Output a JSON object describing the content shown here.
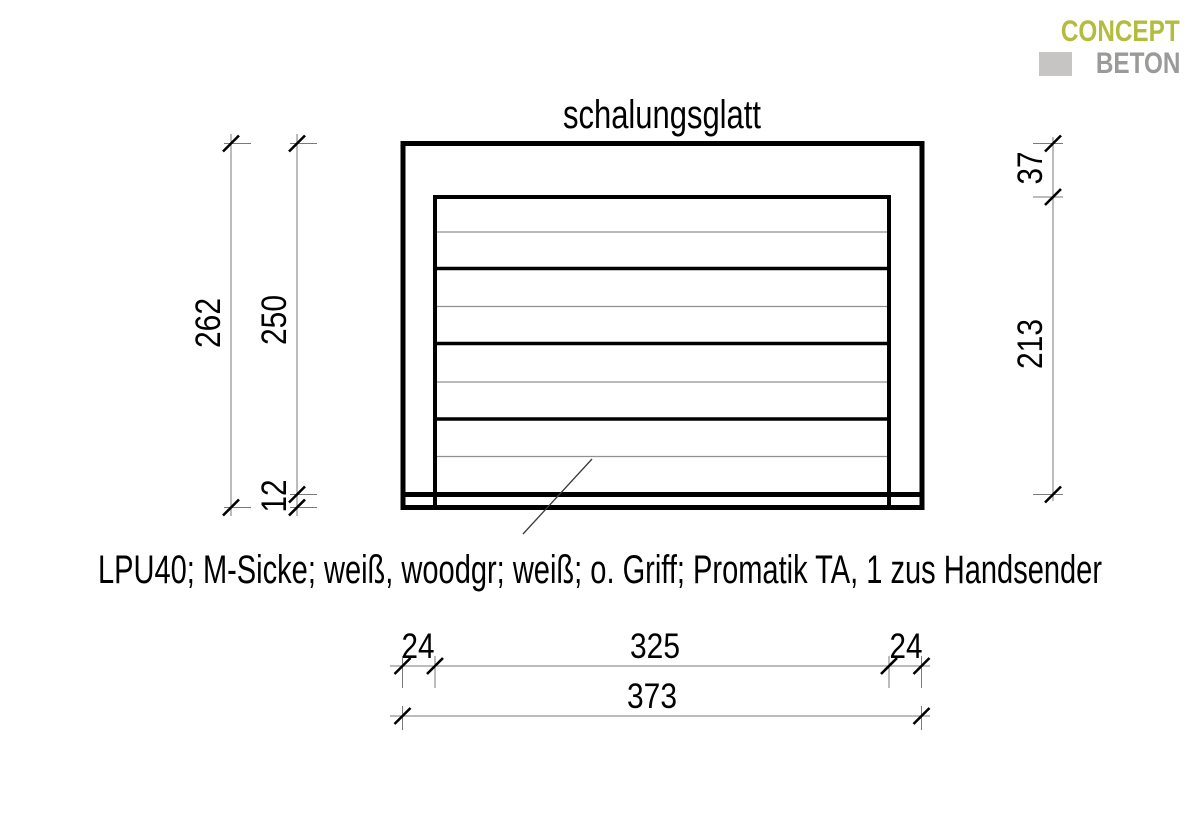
{
  "logo": {
    "line1": "CONCEPT",
    "line2": "BETON",
    "color_primary": "#b4bc3d",
    "color_secondary": "#9b9a99",
    "square_color": "#c6c5c4"
  },
  "drawing": {
    "title": "schalungsglatt",
    "description": "LPU40; M-Sicke; weiß, woodgr; weiß; o. Griff; Promatik TA, 1 zus Handsender",
    "dims": {
      "total_height": "262",
      "opening_height": "250",
      "floor_offset": "12",
      "lintel_height": "37",
      "door_height": "213",
      "jamb_left": "24",
      "opening_width": "325",
      "jamb_right": "24",
      "total_width": "373"
    }
  }
}
